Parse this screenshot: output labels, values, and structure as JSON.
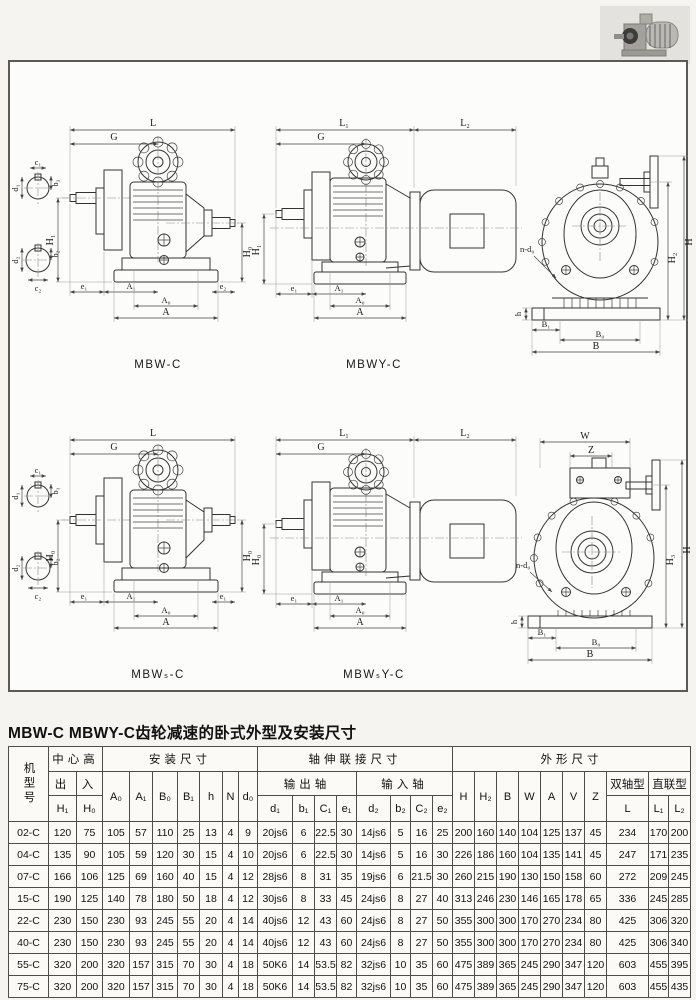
{
  "title": "MBW-C MBWY-C齿轮减速的卧式外型及安装尺寸",
  "icons": {
    "photo": "gear-motor-photo"
  },
  "diagrams": {
    "mbw": {
      "caption": "MBW-C",
      "dims": {
        "L": "L",
        "G": "G",
        "H1": "H₁",
        "H0": "H₀",
        "e1": "e₁",
        "A1": "A₁",
        "A0": "A₀",
        "A": "A",
        "e2": "e₂",
        "c1": "c₁",
        "b1": "b₁",
        "d1": "d₁",
        "c2": "c₂",
        "b2": "b₂",
        "d2": "d₂"
      }
    },
    "mbwy": {
      "caption": "MBWY-C",
      "dims": {
        "L1": "L₁",
        "L2": "L₂",
        "G": "G",
        "H1": "H₁",
        "e1": "e₁",
        "A1": "A₁",
        "A0": "A₀",
        "A": "A"
      }
    },
    "end_top": {
      "dims": {
        "H": "H",
        "H2": "H₂",
        "ndo": "n-d₀",
        "h": "h",
        "B1": "B₁",
        "B0": "B₀",
        "B": "B"
      }
    },
    "mbws": {
      "caption": "MBWₛ-C",
      "dims": {
        "L": "L",
        "G": "G",
        "H0l": "H₀",
        "H0r": "H₀",
        "e1": "e₁",
        "A1": "A₁",
        "A0": "A₀",
        "A": "A",
        "e1r": "e₁",
        "c1": "c₁",
        "b1": "b₁",
        "d1": "d₁",
        "c2": "c₂",
        "b2": "b₂",
        "d2": "d₂"
      }
    },
    "mbwsy": {
      "caption": "MBWₛY-C",
      "dims": {
        "L1": "L₁",
        "L2": "L₂",
        "G": "G",
        "H0": "H₀",
        "e1": "e₁",
        "A1": "A₁",
        "A0": "A₀",
        "A": "A"
      }
    },
    "end_bot": {
      "dims": {
        "W": "W",
        "Z": "Z",
        "H": "H",
        "H3": "H₃",
        "ndo": "n-d₀",
        "h": "h",
        "B1": "B₁",
        "B0": "B₀",
        "B": "B"
      }
    }
  },
  "table": {
    "model_header": "机型号",
    "groups": {
      "center_height": "中心高",
      "mounting": "安装尺寸",
      "shaft_conn": "轴伸联接尺寸",
      "outline": "外形尺寸",
      "out": "出",
      "in": "入",
      "output_shaft": "输出轴",
      "input_shaft": "输入轴",
      "double_shaft": "双轴型",
      "direct_coupled": "直联型"
    },
    "cols": {
      "H1": "H₁",
      "H0": "H₀",
      "A0": "A₀",
      "A1": "A₁",
      "B0": "B₀",
      "B1": "B₁",
      "h": "h",
      "N": "N",
      "d0": "d₀",
      "d1": "d₁",
      "b1": "b₁",
      "C1": "C₁",
      "e1": "e₁",
      "d2": "d₂",
      "b2": "b₂",
      "C2": "C₂",
      "e2": "e₂",
      "H": "H",
      "H2": "H₂",
      "B": "B",
      "W": "W",
      "A": "A",
      "V": "V",
      "Z": "Z",
      "L": "L",
      "L1": "L₁",
      "L2": "L₂"
    },
    "rows": [
      [
        "02-C",
        "120",
        "75",
        "105",
        "57",
        "110",
        "25",
        "13",
        "4",
        "9",
        "20js6",
        "6",
        "22.5",
        "30",
        "14js6",
        "5",
        "16",
        "25",
        "200",
        "160",
        "140",
        "104",
        "125",
        "137",
        "45",
        "234",
        "170",
        "200"
      ],
      [
        "04-C",
        "135",
        "90",
        "105",
        "59",
        "120",
        "30",
        "15",
        "4",
        "10",
        "20js6",
        "6",
        "22.5",
        "30",
        "14js6",
        "5",
        "16",
        "30",
        "226",
        "186",
        "160",
        "104",
        "135",
        "141",
        "45",
        "247",
        "171",
        "235"
      ],
      [
        "07-C",
        "166",
        "106",
        "125",
        "69",
        "160",
        "40",
        "15",
        "4",
        "12",
        "28js6",
        "8",
        "31",
        "35",
        "19js6",
        "6",
        "21.5",
        "30",
        "260",
        "215",
        "190",
        "130",
        "150",
        "158",
        "60",
        "272",
        "209",
        "245"
      ],
      [
        "15-C",
        "190",
        "125",
        "140",
        "78",
        "180",
        "50",
        "18",
        "4",
        "12",
        "30js6",
        "8",
        "33",
        "45",
        "24js6",
        "8",
        "27",
        "40",
        "313",
        "246",
        "230",
        "146",
        "165",
        "178",
        "65",
        "336",
        "245",
        "285"
      ],
      [
        "22-C",
        "230",
        "150",
        "230",
        "93",
        "245",
        "55",
        "20",
        "4",
        "14",
        "40js6",
        "12",
        "43",
        "60",
        "24js6",
        "8",
        "27",
        "50",
        "355",
        "300",
        "300",
        "170",
        "270",
        "234",
        "80",
        "425",
        "306",
        "320"
      ],
      [
        "40-C",
        "230",
        "150",
        "230",
        "93",
        "245",
        "55",
        "20",
        "4",
        "14",
        "40js6",
        "12",
        "43",
        "60",
        "24js6",
        "8",
        "27",
        "50",
        "355",
        "300",
        "300",
        "170",
        "270",
        "234",
        "80",
        "425",
        "306",
        "340"
      ],
      [
        "55-C",
        "320",
        "200",
        "320",
        "157",
        "315",
        "70",
        "30",
        "4",
        "18",
        "50K6",
        "14",
        "53.5",
        "82",
        "32js6",
        "10",
        "35",
        "60",
        "475",
        "389",
        "365",
        "245",
        "290",
        "347",
        "120",
        "603",
        "455",
        "395"
      ],
      [
        "75-C",
        "320",
        "200",
        "320",
        "157",
        "315",
        "70",
        "30",
        "4",
        "18",
        "50K6",
        "14",
        "53.5",
        "82",
        "32js6",
        "10",
        "35",
        "60",
        "475",
        "389",
        "365",
        "245",
        "290",
        "347",
        "120",
        "603",
        "455",
        "435"
      ]
    ]
  }
}
